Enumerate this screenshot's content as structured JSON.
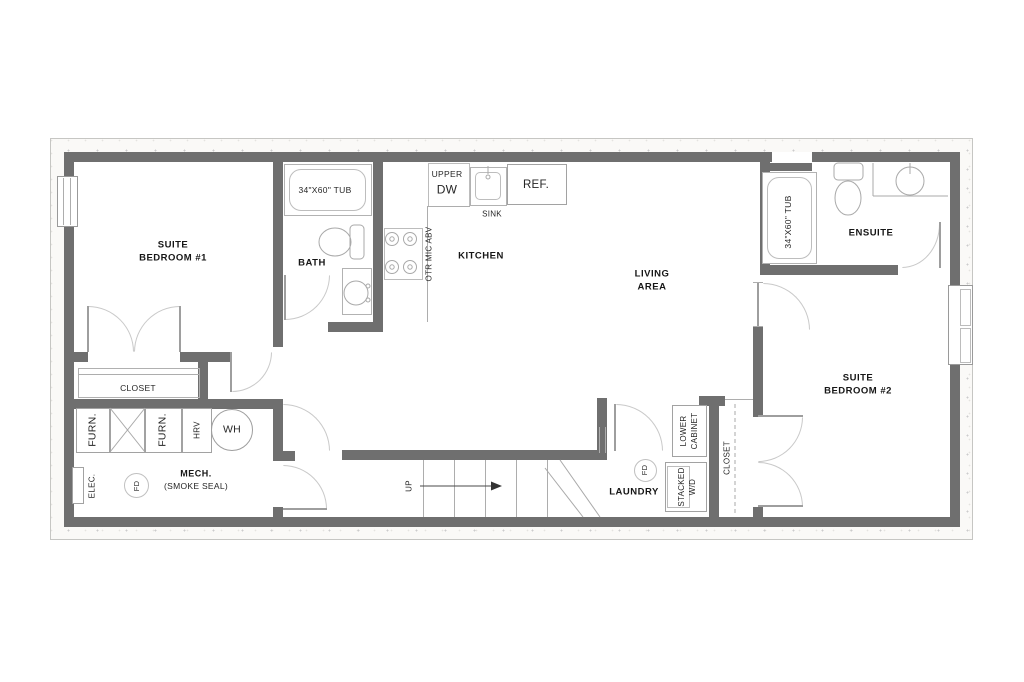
{
  "labels": {
    "bedroom1": "SUITE\nBEDROOM #1",
    "bath": "BATH",
    "bath_tub": "34\"X60\" TUB",
    "upper": "UPPER",
    "dw": "DW",
    "sink": "SINK",
    "ref": "REF.",
    "otr_mic": "OTR MIC ABV",
    "kitchen": "KITCHEN",
    "living": "LIVING\nAREA",
    "ensuite": "ENSUITE",
    "ensuite_tub": "34\"X60\" TUB",
    "bedroom2": "SUITE\nBEDROOM #2",
    "closet1": "CLOSET",
    "closet2": "CLOSET",
    "furn1": "FURN.",
    "furn2": "FURN.",
    "hrv": "HRV",
    "wh": "WH",
    "elec": "ELEC.",
    "fd_mech": "FD",
    "mech": "MECH.",
    "smoke_seal": "(SMOKE SEAL)",
    "up": "UP",
    "laundry": "LAUNDRY",
    "fd_laundry": "FD",
    "stacked_wd": "STACKED\nW/D",
    "lower_cabinet": "LOWER\nCABINET"
  },
  "colors": {
    "wall": "#6f6f6f",
    "thin_line": "#a8a8a8",
    "text": "#161616",
    "band": "#faf9f7"
  }
}
